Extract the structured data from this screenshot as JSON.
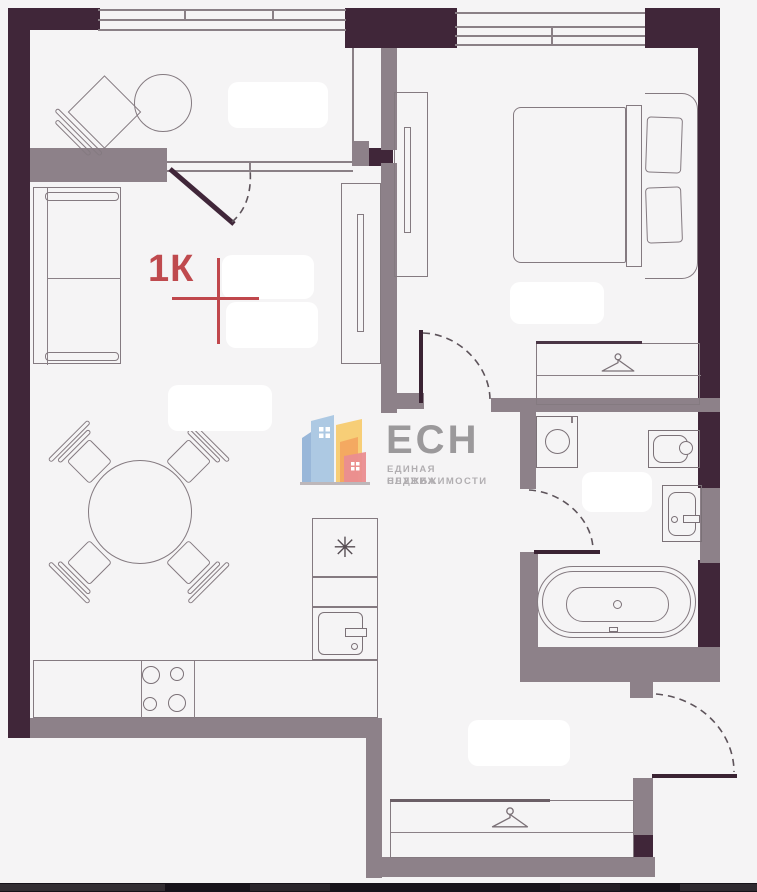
{
  "plan": {
    "unit_label": "1К"
  },
  "logo": {
    "name": "ЕСН",
    "tagline_line1": "ЕДИНАЯ СЛУЖБА",
    "tagline_line2": "НЕДВИЖИМОСТИ"
  },
  "symbols": {
    "fridge_snowflake": "✳"
  },
  "colors": {
    "background": "#f5f4f5",
    "wall_dark": "#402639",
    "wall_gray": "#8d8189",
    "furniture_line": "#847a80",
    "accent_red": "#bf4a4e",
    "logo_text": "#9b999b",
    "logo_subtext": "#b1aeb1",
    "logo_blue": "#a9c6e2",
    "logo_yellow": "#f7cb70",
    "logo_orange": "#f3a660",
    "logo_pink": "#ea8d90"
  }
}
